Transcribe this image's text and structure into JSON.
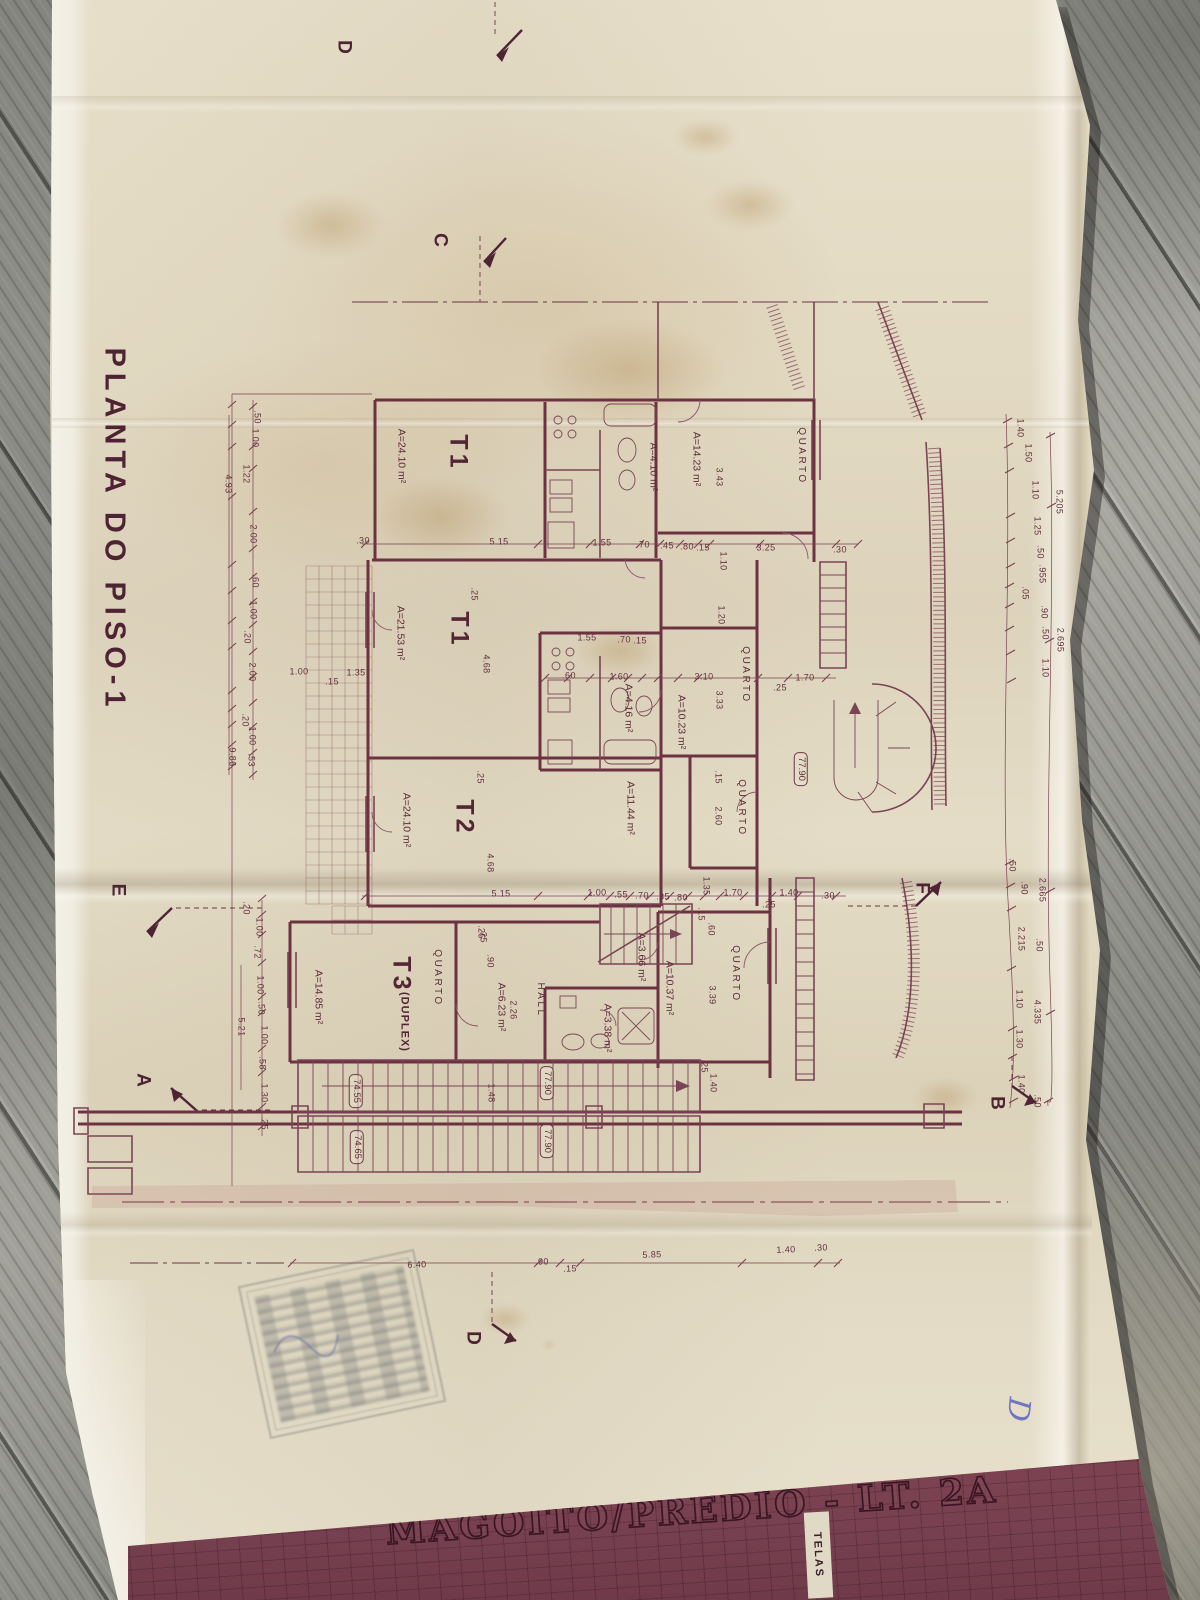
{
  "drawing": {
    "plan_title": "PLANTA DO PISO-1",
    "project_title": "MAGOITO/PRÉDIO - LT. 2A",
    "telas_label": "TELAS",
    "handwritten_mark": "D"
  },
  "ink": {
    "line": "#7a4150",
    "walls": "#6d3242",
    "text": "#5e2b3b",
    "band": "#7b4050"
  },
  "units": [
    {
      "name": "T1",
      "area": "A=24.10 m²"
    },
    {
      "name": "T1",
      "area": "A=21.53 m²"
    },
    {
      "name": "T2",
      "area": "A=24.10 m²"
    },
    {
      "name": "T3 (DUPLEX)",
      "area": "A=14.85 m²"
    }
  ],
  "levels": [
    "77.90",
    "74.55",
    "74.65"
  ],
  "section_markers": [
    "A",
    "B",
    "C",
    "D",
    "E",
    "F"
  ],
  "annotations": [
    {
      "t": "PLANTA DO PISO-1",
      "x": 114,
      "y": 530,
      "r": 90,
      "k": "ptitle"
    },
    {
      "t": "C",
      "x": 440,
      "y": 240,
      "r": 90,
      "k": "marker"
    },
    {
      "t": "D",
      "x": 344,
      "y": 47,
      "r": 90,
      "k": "marker"
    },
    {
      "t": "E",
      "x": 118,
      "y": 890,
      "r": 90,
      "k": "marker"
    },
    {
      "t": "A",
      "x": 143,
      "y": 1080,
      "r": 90,
      "k": "marker"
    },
    {
      "t": "F",
      "x": 922,
      "y": 888,
      "r": 90,
      "k": "marker"
    },
    {
      "t": "B",
      "x": 997,
      "y": 1103,
      "r": 90,
      "k": "marker"
    },
    {
      "t": "D",
      "x": 473,
      "y": 1338,
      "r": 90,
      "k": "marker"
    },
    {
      "t": "T1",
      "x": 458,
      "y": 453,
      "r": 90,
      "k": "room"
    },
    {
      "t": "T1",
      "x": 459,
      "y": 630,
      "r": 90,
      "k": "room"
    },
    {
      "t": "T2",
      "x": 464,
      "y": 818,
      "r": 90,
      "k": "room"
    },
    {
      "t": "T3",
      "x": 401,
      "y": 975,
      "r": 90,
      "k": "room"
    },
    {
      "t": "(DUPLEX)",
      "x": 404,
      "y": 1022,
      "r": 90,
      "k": "roomsub"
    },
    {
      "t": "QUARTO",
      "x": 801,
      "y": 456,
      "r": 90,
      "k": "quarto"
    },
    {
      "t": "QUARTO",
      "x": 745,
      "y": 675,
      "r": 90,
      "k": "quarto"
    },
    {
      "t": "QUARTO",
      "x": 741,
      "y": 808,
      "r": 90,
      "k": "quarto"
    },
    {
      "t": "QUARTO",
      "x": 437,
      "y": 978,
      "r": 90,
      "k": "quarto"
    },
    {
      "t": "QUARTO",
      "x": 735,
      "y": 974,
      "r": 90,
      "k": "quarto"
    },
    {
      "t": "HALL",
      "x": 540,
      "y": 1000,
      "r": 90,
      "k": "quarto"
    },
    {
      "t": "A=24.10 m²",
      "x": 401,
      "y": 456,
      "r": 90,
      "k": "area"
    },
    {
      "t": "A=21.53 m²",
      "x": 400,
      "y": 633,
      "r": 90,
      "k": "area"
    },
    {
      "t": "A=24.10 m²",
      "x": 406,
      "y": 820,
      "r": 90,
      "k": "area"
    },
    {
      "t": "A=14.85 m²",
      "x": 318,
      "y": 997,
      "r": 90,
      "k": "area"
    },
    {
      "t": "A=14.23 m²",
      "x": 696,
      "y": 459,
      "r": 90,
      "k": "area"
    },
    {
      "t": "A=4.10 m²",
      "x": 653,
      "y": 467,
      "r": 90,
      "k": "area"
    },
    {
      "t": "A=4.16 m²",
      "x": 628,
      "y": 708,
      "r": 90,
      "k": "area"
    },
    {
      "t": "A=10.23 m²",
      "x": 681,
      "y": 722,
      "r": 90,
      "k": "area"
    },
    {
      "t": "A=11.44 m²",
      "x": 630,
      "y": 808,
      "r": 90,
      "k": "area"
    },
    {
      "t": "A=3.66 m²",
      "x": 641,
      "y": 957,
      "r": 90,
      "k": "area"
    },
    {
      "t": "A=10.37 m²",
      "x": 669,
      "y": 988,
      "r": 90,
      "k": "area"
    },
    {
      "t": "A=3.38 m²",
      "x": 607,
      "y": 1028,
      "r": 90,
      "k": "area"
    },
    {
      "t": "A=6.23 m²",
      "x": 501,
      "y": 1007,
      "r": 90,
      "k": "area"
    },
    {
      "t": "77.90",
      "x": 801,
      "y": 769,
      "r": 90,
      "k": "level"
    },
    {
      "t": "77.90",
      "x": 547,
      "y": 1083,
      "r": 90,
      "k": "level"
    },
    {
      "t": "77.90",
      "x": 547,
      "y": 1141,
      "r": 90,
      "k": "level"
    },
    {
      "t": "74.55",
      "x": 356,
      "y": 1091,
      "r": 90,
      "k": "level"
    },
    {
      "t": "74.65",
      "x": 357,
      "y": 1147,
      "r": 90,
      "k": "level"
    },
    {
      "t": "5.15",
      "x": 499,
      "y": 542,
      "r": 0,
      "k": "dim"
    },
    {
      "t": "1.55",
      "x": 602,
      "y": 543,
      "r": 0,
      "k": "dim"
    },
    {
      "t": ".70",
      "x": 643,
      "y": 545,
      "r": 0,
      "k": "dim"
    },
    {
      "t": ".45",
      "x": 667,
      "y": 546,
      "r": 0,
      "k": "dim"
    },
    {
      "t": ".80",
      "x": 687,
      "y": 547,
      "r": 0,
      "k": "dim"
    },
    {
      "t": ".15",
      "x": 703,
      "y": 548,
      "r": 0,
      "k": "dim"
    },
    {
      "t": "3.25",
      "x": 766,
      "y": 548,
      "r": 0,
      "k": "dim"
    },
    {
      "t": ".30",
      "x": 840,
      "y": 550,
      "r": 0,
      "k": "dim"
    },
    {
      "t": "1.55",
      "x": 587,
      "y": 638,
      "r": 0,
      "k": "dim"
    },
    {
      "t": ".70",
      "x": 624,
      "y": 640,
      "r": 0,
      "k": "dim"
    },
    {
      "t": ".15",
      "x": 640,
      "y": 641,
      "r": 0,
      "k": "dim"
    },
    {
      "t": ".60",
      "x": 569,
      "y": 676,
      "r": 0,
      "k": "dim"
    },
    {
      "t": "1.60",
      "x": 619,
      "y": 677,
      "r": 0,
      "k": "dim"
    },
    {
      "t": "3.10",
      "x": 704,
      "y": 677,
      "r": 0,
      "k": "dim"
    },
    {
      "t": "1.70",
      "x": 805,
      "y": 678,
      "r": 0,
      "k": "dim"
    },
    {
      "t": ".25",
      "x": 780,
      "y": 688,
      "r": 0,
      "k": "dim"
    },
    {
      "t": "1.00",
      "x": 299,
      "y": 672,
      "r": 0,
      "k": "dim"
    },
    {
      "t": "1.35",
      "x": 356,
      "y": 673,
      "r": 0,
      "k": "dim"
    },
    {
      "t": ".15",
      "x": 332,
      "y": 682,
      "r": 0,
      "k": "dim"
    },
    {
      "t": ".30",
      "x": 363,
      "y": 541,
      "r": 0,
      "k": "dim"
    },
    {
      "t": "5.15",
      "x": 501,
      "y": 894,
      "r": 0,
      "k": "dim"
    },
    {
      "t": "1.00",
      "x": 597,
      "y": 893,
      "r": 0,
      "k": "dim"
    },
    {
      "t": ".55",
      "x": 621,
      "y": 895,
      "r": 0,
      "k": "dim"
    },
    {
      "t": ".70",
      "x": 642,
      "y": 896,
      "r": 0,
      "k": "dim"
    },
    {
      "t": ".35",
      "x": 663,
      "y": 897,
      "r": 0,
      "k": "dim"
    },
    {
      "t": ".80",
      "x": 681,
      "y": 898,
      "r": 0,
      "k": "dim"
    },
    {
      "t": "1.70",
      "x": 733,
      "y": 893,
      "r": 0,
      "k": "dim"
    },
    {
      "t": "1.40",
      "x": 789,
      "y": 893,
      "r": 0,
      "k": "dim"
    },
    {
      "t": ".30",
      "x": 828,
      "y": 896,
      "r": 0,
      "k": "dim"
    },
    {
      "t": ".25",
      "x": 769,
      "y": 905,
      "r": 0,
      "k": "dim"
    },
    {
      "t": "6.40",
      "x": 417,
      "y": 1265,
      "r": -2,
      "k": "dim"
    },
    {
      "t": ".90",
      "x": 542,
      "y": 1262,
      "r": -2,
      "k": "dim"
    },
    {
      "t": ".15",
      "x": 570,
      "y": 1269,
      "r": -2,
      "k": "dim"
    },
    {
      "t": "5.85",
      "x": 652,
      "y": 1255,
      "r": -2,
      "k": "dim"
    },
    {
      "t": "1.40",
      "x": 786,
      "y": 1250,
      "r": -2,
      "k": "dim"
    },
    {
      "t": ".30",
      "x": 821,
      "y": 1248,
      "r": -2,
      "k": "dim"
    },
    {
      "t": "3.43",
      "x": 719,
      "y": 477,
      "r": 90,
      "k": "dimv"
    },
    {
      "t": "1.10",
      "x": 723,
      "y": 561,
      "r": 90,
      "k": "dimv"
    },
    {
      "t": "1.20",
      "x": 721,
      "y": 615,
      "r": 90,
      "k": "dimv"
    },
    {
      "t": "3.33",
      "x": 719,
      "y": 700,
      "r": 90,
      "k": "dimv"
    },
    {
      "t": ".15",
      "x": 718,
      "y": 777,
      "r": 90,
      "k": "dimv"
    },
    {
      "t": "2.60",
      "x": 718,
      "y": 816,
      "r": 90,
      "k": "dimv"
    },
    {
      "t": ".25",
      "x": 474,
      "y": 594,
      "r": 90,
      "k": "dimv"
    },
    {
      "t": "4.68",
      "x": 486,
      "y": 664,
      "r": 90,
      "k": "dimv"
    },
    {
      "t": ".25",
      "x": 480,
      "y": 777,
      "r": 90,
      "k": "dimv"
    },
    {
      "t": "4.68",
      "x": 490,
      "y": 863,
      "r": 90,
      "k": "dimv"
    },
    {
      "t": ".25",
      "x": 481,
      "y": 932,
      "r": 90,
      "k": "dimv"
    },
    {
      "t": "1.35",
      "x": 706,
      "y": 886,
      "r": 90,
      "k": "dimv"
    },
    {
      "t": ".15",
      "x": 701,
      "y": 914,
      "r": 90,
      "k": "dimv"
    },
    {
      "t": ".60",
      "x": 711,
      "y": 929,
      "r": 90,
      "k": "dimv"
    },
    {
      "t": "3.39",
      "x": 712,
      "y": 995,
      "r": 90,
      "k": "dimv"
    },
    {
      "t": ".25",
      "x": 704,
      "y": 1066,
      "r": 90,
      "k": "dimv"
    },
    {
      "t": "1.40",
      "x": 713,
      "y": 1083,
      "r": 90,
      "k": "dimv"
    },
    {
      "t": ".25",
      "x": 483,
      "y": 936,
      "r": 90,
      "k": "dimv"
    },
    {
      "t": ".90",
      "x": 490,
      "y": 961,
      "r": 90,
      "k": "dimv"
    },
    {
      "t": "2.26",
      "x": 513,
      "y": 1010,
      "r": 90,
      "k": "dimv"
    },
    {
      "t": "1.48",
      "x": 491,
      "y": 1093,
      "r": 90,
      "k": "dimv"
    },
    {
      "t": ".50",
      "x": 257,
      "y": 417,
      "r": 90,
      "k": "dimv"
    },
    {
      "t": "1.00",
      "x": 255,
      "y": 438,
      "r": 90,
      "k": "dimv"
    },
    {
      "t": "1.22",
      "x": 246,
      "y": 474,
      "r": 90,
      "k": "dimv"
    },
    {
      "t": "4.93",
      "x": 228,
      "y": 484,
      "r": 90,
      "k": "dimv"
    },
    {
      "t": "2.00",
      "x": 253,
      "y": 534,
      "r": 90,
      "k": "dimv"
    },
    {
      "t": ".60",
      "x": 255,
      "y": 581,
      "r": 90,
      "k": "dimv"
    },
    {
      "t": "1.00",
      "x": 253,
      "y": 610,
      "r": 90,
      "k": "dimv"
    },
    {
      "t": ".20",
      "x": 247,
      "y": 637,
      "r": 90,
      "k": "dimv"
    },
    {
      "t": "2.00",
      "x": 252,
      "y": 672,
      "r": 90,
      "k": "dimv"
    },
    {
      "t": ".20",
      "x": 245,
      "y": 720,
      "r": 90,
      "k": "dimv"
    },
    {
      "t": "1.00",
      "x": 252,
      "y": 736,
      "r": 90,
      "k": "dimv"
    },
    {
      "t": ".53",
      "x": 251,
      "y": 760,
      "r": 90,
      "k": "dimv"
    },
    {
      "t": "9.86",
      "x": 232,
      "y": 757,
      "r": 90,
      "k": "dimv"
    },
    {
      "t": ".20",
      "x": 246,
      "y": 908,
      "r": 90,
      "k": "dimv"
    },
    {
      "t": "1.00",
      "x": 259,
      "y": 927,
      "r": 90,
      "k": "dimv"
    },
    {
      "t": ".72",
      "x": 257,
      "y": 952,
      "r": 90,
      "k": "dimv"
    },
    {
      "t": "1.00",
      "x": 260,
      "y": 985,
      "r": 90,
      "k": "dimv"
    },
    {
      "t": ".50",
      "x": 261,
      "y": 1008,
      "r": 90,
      "k": "dimv"
    },
    {
      "t": "1.00",
      "x": 264,
      "y": 1035,
      "r": 90,
      "k": "dimv"
    },
    {
      "t": ".58",
      "x": 262,
      "y": 1063,
      "r": 90,
      "k": "dimv"
    },
    {
      "t": "1.30",
      "x": 264,
      "y": 1093,
      "r": 90,
      "k": "dimv"
    },
    {
      "t": ".25",
      "x": 264,
      "y": 1123,
      "r": 90,
      "k": "dimv"
    },
    {
      "t": "5.21",
      "x": 241,
      "y": 1027,
      "r": 90,
      "k": "dimv"
    },
    {
      "t": "1.40",
      "x": 1020,
      "y": 428,
      "r": 90,
      "k": "dimv"
    },
    {
      "t": "1.50",
      "x": 1028,
      "y": 453,
      "r": 90,
      "k": "dimv"
    },
    {
      "t": "1.10",
      "x": 1035,
      "y": 490,
      "r": 90,
      "k": "dimv"
    },
    {
      "t": "5.205",
      "x": 1059,
      "y": 502,
      "r": 90,
      "k": "dimv"
    },
    {
      "t": "1.25",
      "x": 1037,
      "y": 526,
      "r": 90,
      "k": "dimv"
    },
    {
      "t": ".50",
      "x": 1040,
      "y": 552,
      "r": 90,
      "k": "dimv"
    },
    {
      "t": ".955",
      "x": 1042,
      "y": 574,
      "r": 90,
      "k": "dimv"
    },
    {
      "t": ".05",
      "x": 1025,
      "y": 593,
      "r": 90,
      "k": "dimv"
    },
    {
      "t": ".90",
      "x": 1044,
      "y": 612,
      "r": 90,
      "k": "dimv"
    },
    {
      "t": ".50",
      "x": 1045,
      "y": 633,
      "r": 90,
      "k": "dimv"
    },
    {
      "t": "2.695",
      "x": 1060,
      "y": 640,
      "r": 90,
      "k": "dimv"
    },
    {
      "t": "1.10",
      "x": 1045,
      "y": 668,
      "r": 90,
      "k": "dimv"
    },
    {
      "t": ".50",
      "x": 1012,
      "y": 865,
      "r": 90,
      "k": "dimv"
    },
    {
      "t": ".90",
      "x": 1024,
      "y": 888,
      "r": 90,
      "k": "dimv"
    },
    {
      "t": "2.665",
      "x": 1042,
      "y": 890,
      "r": 90,
      "k": "dimv"
    },
    {
      "t": "2.215",
      "x": 1021,
      "y": 939,
      "r": 90,
      "k": "dimv"
    },
    {
      "t": ".50",
      "x": 1039,
      "y": 945,
      "r": 90,
      "k": "dimv"
    },
    {
      "t": "1.10",
      "x": 1019,
      "y": 999,
      "r": 90,
      "k": "dimv"
    },
    {
      "t": "4.335",
      "x": 1037,
      "y": 1012,
      "r": 90,
      "k": "dimv"
    },
    {
      "t": "1.30",
      "x": 1019,
      "y": 1039,
      "r": 90,
      "k": "dimv"
    },
    {
      "t": "1.40",
      "x": 1021,
      "y": 1084,
      "r": 90,
      "k": "dimv"
    },
    {
      "t": ".50",
      "x": 1037,
      "y": 1101,
      "r": 90,
      "k": "dimv"
    }
  ]
}
